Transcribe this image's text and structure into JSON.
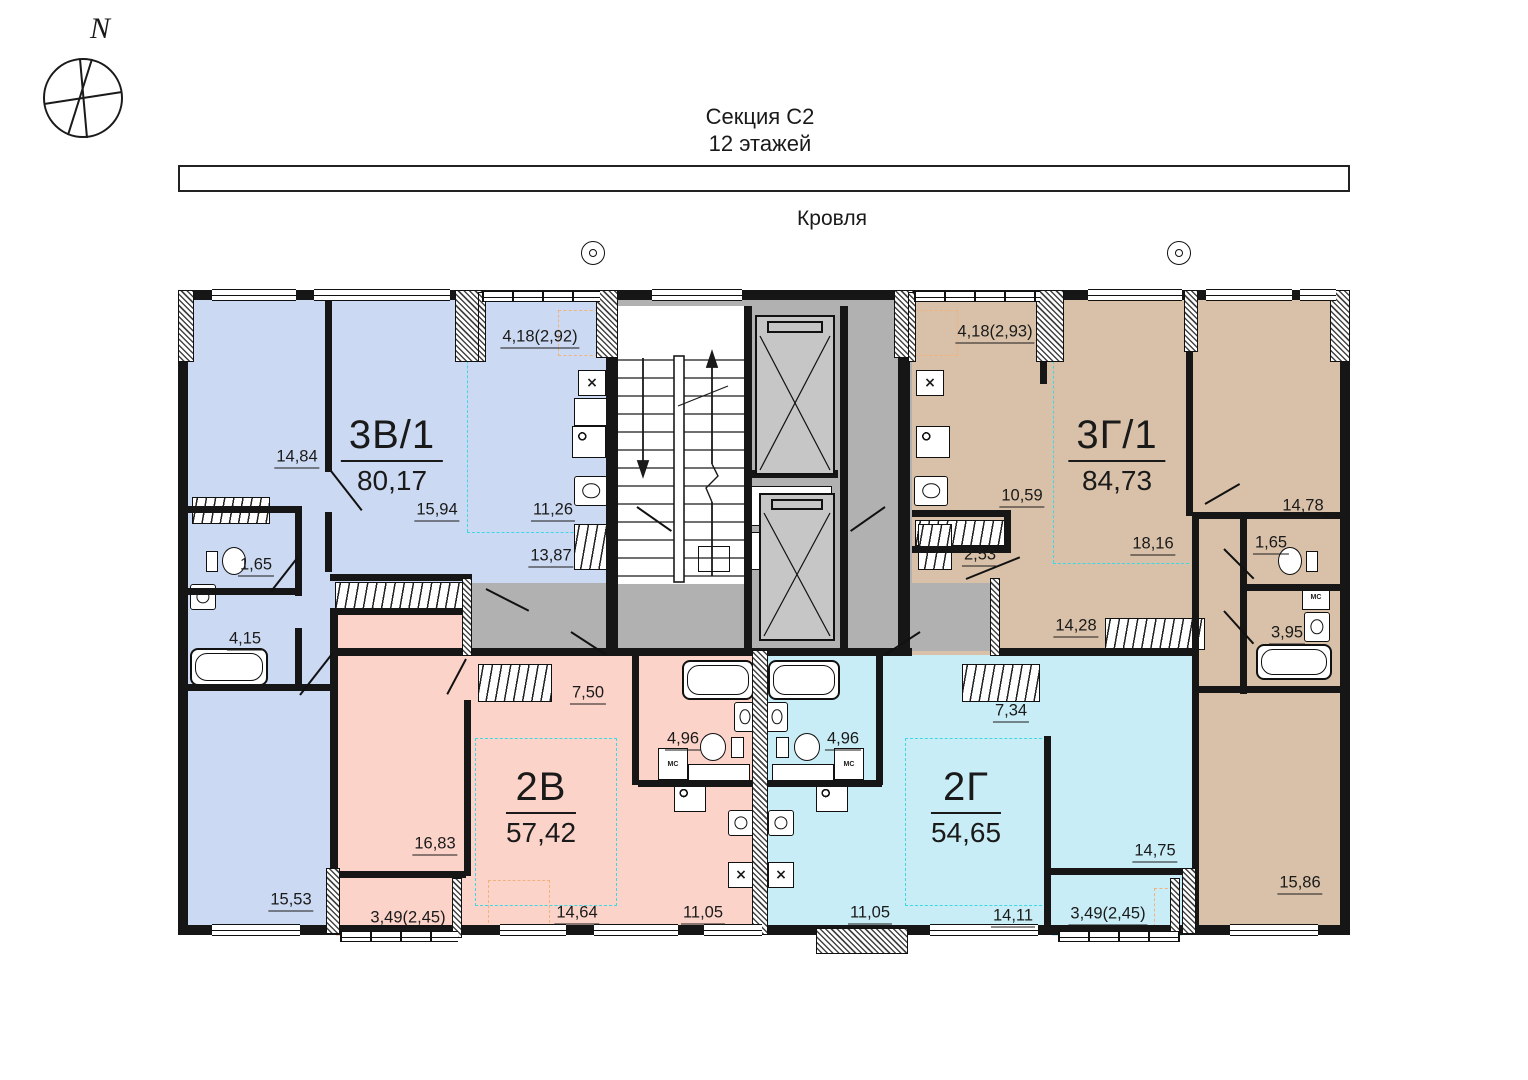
{
  "compass": {
    "north": "N"
  },
  "header": {
    "section": "Секция С2",
    "floors": "12 этажей"
  },
  "roof": {
    "label": "Кровля"
  },
  "apartments": {
    "blue": {
      "name": "3В/1",
      "area": "80,17"
    },
    "tan": {
      "name": "3Г/1",
      "area": "84,73"
    },
    "pink": {
      "name": "2В",
      "area": "57,42"
    },
    "cyan": {
      "name": "2Г",
      "area": "54,65"
    }
  },
  "rooms": {
    "blue_balcony": "4,18(2,92)",
    "blue_bedroom": "14,84",
    "blue_living": "15,94",
    "blue_kitchen": "11,26",
    "blue_hall": "13,87",
    "blue_wc": "1,65",
    "blue_bath": "4,15",
    "blue_bedroom2": "15,53",
    "tan_balcony": "4,18(2,93)",
    "tan_kitchen": "10,59",
    "tan_wardrobe": "2,53",
    "tan_living": "18,16",
    "tan_bedroom": "14,78",
    "tan_wc": "1,65",
    "tan_bath": "3,95",
    "tan_hall": "14,28",
    "tan_bedroom2": "15,86",
    "pink_hall": "7,50",
    "pink_bath": "4,96",
    "pink_bedroom": "16,83",
    "pink_living": "14,64",
    "pink_kitchen": "11,05",
    "pink_balcony": "3,49(2,45)",
    "cyan_bath": "4,96",
    "cyan_hall": "7,34",
    "cyan_kitchen": "11,05",
    "cyan_living": "14,11",
    "cyan_bedroom": "14,75",
    "cyan_balcony": "3,49(2,45)"
  },
  "fixtures": {
    "washing_machine": "МС"
  },
  "colors": {
    "blue": "#ccd9f2",
    "tan": "#d8c1a8",
    "pink": "#fcd3c9",
    "cyan": "#c9edf6",
    "core_gray": "#b1b1b1",
    "zone": "#3fd7e6",
    "orange": "#f2b27d",
    "wall": "#161616"
  }
}
